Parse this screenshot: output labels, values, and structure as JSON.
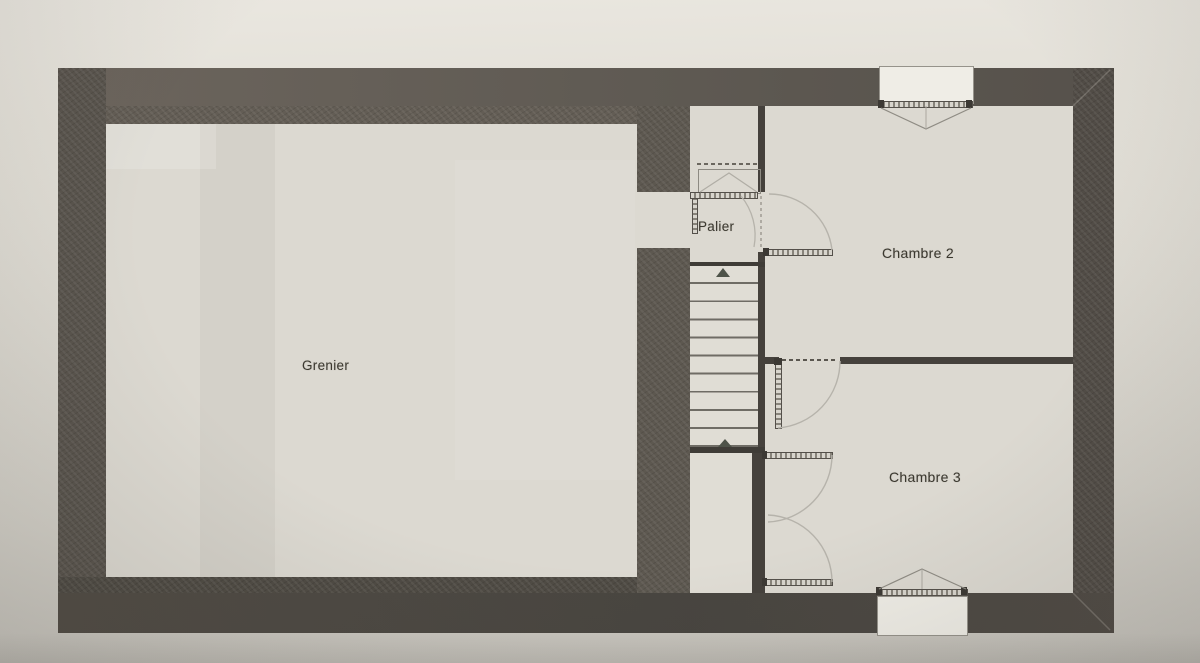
{
  "plan": {
    "rooms": [
      {
        "id": "grenier",
        "label": "Grenier"
      },
      {
        "id": "palier",
        "label": "Palier"
      },
      {
        "id": "chambre-2",
        "label": "Chambre 2"
      },
      {
        "id": "chambre-3",
        "label": "Chambre 3"
      }
    ],
    "stairs": {
      "tread_count": 10,
      "direction_arrow_count": 2
    },
    "window_count": 2,
    "door_count": 5,
    "colors": {
      "wall_dark": "#57524b",
      "paper": "#d9d6cf",
      "room_fill": "#dcd9d1",
      "drawing_line": "#6f6c65",
      "door_arc": "#b6b3ab",
      "label_text": "#3b382f"
    }
  }
}
